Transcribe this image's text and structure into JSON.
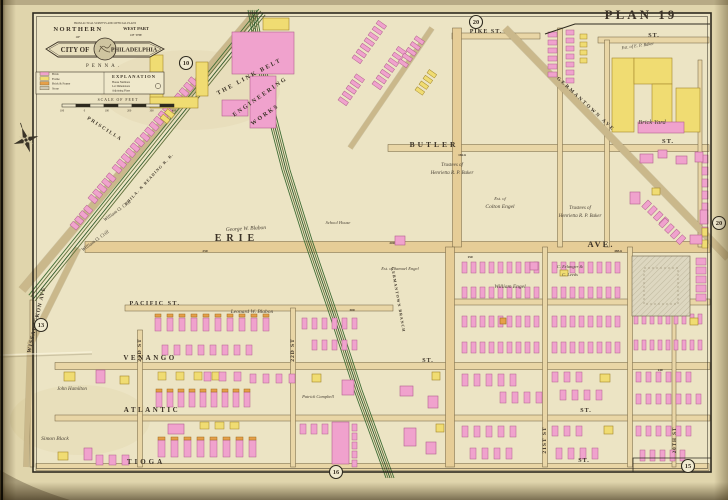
{
  "page": {
    "plate_label": "PLAN 19"
  },
  "cartouche": {
    "title_line1": "NORTHERN",
    "title_line1b": "OF",
    "title_line2": "WEST PART",
    "title_line2b": "OF THE",
    "arc_note": "FROM ACTUAL SURVEYS AND OFFICIAL PLANS",
    "banner_left": "CITY OF",
    "banner_right": "PHILADELPHIA",
    "subtitle": "PENNA."
  },
  "legend": {
    "title": "EXPLANATION",
    "items": [
      {
        "label": "Brick",
        "color": "#f0a2cd"
      },
      {
        "label": "Frame",
        "color": "#f0dc72"
      },
      {
        "label": "Brick & Frame",
        "color": "#e6a049"
      },
      {
        "label": "Stone",
        "color": "#cfc8b2"
      }
    ],
    "notes": [
      "House Numbers",
      "Lot Dimensions",
      "Adjoining Plans"
    ],
    "scale_title": "SCALE OF FEET",
    "scale_ticks": [
      "100",
      "0",
      "100",
      "200",
      "300",
      "400"
    ]
  },
  "plate_refs": [
    {
      "n": "10",
      "x": 186,
      "y": 63
    },
    {
      "n": "20",
      "x": 476,
      "y": 22
    },
    {
      "n": "20",
      "x": 719,
      "y": 223
    },
    {
      "n": "13",
      "x": 41,
      "y": 325
    },
    {
      "n": "16",
      "x": 336,
      "y": 472
    },
    {
      "n": "15",
      "x": 688,
      "y": 466
    }
  ],
  "map_labels": [
    {
      "t": "PIKE ST.",
      "x": 486,
      "y": 33,
      "s": 6,
      "ls": 1
    },
    {
      "t": "BUTLER",
      "x": 434,
      "y": 147,
      "s": 7.5,
      "ls": 3
    },
    {
      "t": "ST.",
      "x": 668,
      "y": 143,
      "s": 6.5,
      "ls": 1
    },
    {
      "t": "ST.",
      "x": 654,
      "y": 37,
      "s": 6,
      "ls": 1
    },
    {
      "t": "ERIE",
      "x": 237,
      "y": 241,
      "s": 10,
      "ls": 5
    },
    {
      "t": "AVE.",
      "x": 601,
      "y": 247,
      "s": 8.5,
      "ls": 2
    },
    {
      "t": "PACIFIC ST.",
      "x": 155,
      "y": 305,
      "s": 6,
      "ls": 1.5
    },
    {
      "t": "VENANGO",
      "x": 150,
      "y": 360,
      "s": 7,
      "ls": 2.5
    },
    {
      "t": "ST.",
      "x": 428,
      "y": 362,
      "s": 6,
      "ls": 1
    },
    {
      "t": "ATLANTIC",
      "x": 152,
      "y": 412,
      "s": 7,
      "ls": 2.5
    },
    {
      "t": "ST.",
      "x": 586,
      "y": 412,
      "s": 6,
      "ls": 1
    },
    {
      "t": "TIOGA",
      "x": 146,
      "y": 464,
      "s": 7,
      "ls": 3
    },
    {
      "t": "ST.",
      "x": 584,
      "y": 462,
      "s": 6,
      "ls": 1
    },
    {
      "t": "23D ST",
      "x": 141,
      "y": 350,
      "s": 5.5,
      "r": -90,
      "ls": 1
    },
    {
      "t": "22D ST",
      "x": 294,
      "y": 350,
      "s": 5.5,
      "r": -90,
      "ls": 1
    },
    {
      "t": "21ST ST",
      "x": 546,
      "y": 440,
      "s": 5.5,
      "r": -90,
      "ls": 1
    },
    {
      "t": "20TH ST",
      "x": 676,
      "y": 440,
      "s": 5,
      "r": -90,
      "ls": 1
    },
    {
      "t": "WISSAHICKON AVE",
      "x": 38,
      "y": 320,
      "s": 5.5,
      "r": -77,
      "ls": 1
    },
    {
      "t": "PRISCILLA",
      "x": 104,
      "y": 130,
      "s": 5,
      "r": 33,
      "ls": 1.5
    },
    {
      "t": "GERMANTOWN AVE",
      "x": 585,
      "y": 105,
      "s": 5,
      "r": 43,
      "ls": 2
    },
    {
      "t": "GERMANTOWN BRANCH",
      "x": 397,
      "y": 300,
      "s": 4,
      "r": 80,
      "ls": 1,
      "c": "#5a6b45"
    },
    {
      "t": "PHILA. & READING R. R.",
      "x": 150,
      "y": 180,
      "s": 4,
      "r": -47,
      "ls": 1,
      "c": "#5a6b45"
    },
    {
      "t": "THE LINK BELT",
      "x": 250,
      "y": 78,
      "s": 6,
      "r": -28,
      "ls": 2
    },
    {
      "t": "ENGINEERING",
      "x": 261,
      "y": 98,
      "s": 6,
      "r": -35,
      "ls": 2
    },
    {
      "t": "WORKS",
      "x": 266,
      "y": 116,
      "s": 6,
      "r": -35,
      "ls": 2
    },
    {
      "t": "Brick Yard",
      "x": 652,
      "y": 124,
      "s": 6.5,
      "f": "it"
    },
    {
      "t": "Est. of E. P. Baker",
      "x": 638,
      "y": 47,
      "s": 4.5,
      "f": "it",
      "r": -8
    },
    {
      "t": "Trustees of",
      "x": 452,
      "y": 166,
      "s": 5,
      "f": "it"
    },
    {
      "t": "Henrietta R. P. Baker",
      "x": 452,
      "y": 174,
      "s": 5,
      "f": "it"
    },
    {
      "t": "Trustees of",
      "x": 580,
      "y": 209,
      "s": 5,
      "f": "it"
    },
    {
      "t": "Henrietta R. P. Baker",
      "x": 580,
      "y": 217,
      "s": 5,
      "f": "it"
    },
    {
      "t": "Est. of",
      "x": 500,
      "y": 200,
      "s": 4.5,
      "f": "it"
    },
    {
      "t": "Colton Engel",
      "x": 500,
      "y": 208,
      "s": 5.5,
      "f": "it"
    },
    {
      "t": "William Engel",
      "x": 510,
      "y": 288,
      "s": 5.5,
      "f": "it"
    },
    {
      "t": "C. Erlanger &",
      "x": 570,
      "y": 268,
      "s": 4.5,
      "f": "it"
    },
    {
      "t": "C. Leeds",
      "x": 570,
      "y": 276,
      "s": 4.5,
      "f": "it"
    },
    {
      "t": "George W. Blabon",
      "x": 246,
      "y": 230,
      "s": 5.5,
      "f": "it",
      "r": -3
    },
    {
      "t": "Leonard W. Blabon",
      "x": 252,
      "y": 313,
      "s": 5.5,
      "f": "it"
    },
    {
      "t": "Est. of Samuel Engel",
      "x": 400,
      "y": 270,
      "s": 4.5,
      "f": "it"
    },
    {
      "t": "William O. Crill",
      "x": 118,
      "y": 212,
      "s": 5,
      "f": "it",
      "r": -36
    },
    {
      "t": "William O. Crill",
      "x": 96,
      "y": 242,
      "s": 5,
      "f": "it",
      "r": -36
    },
    {
      "t": "School House",
      "x": 338,
      "y": 224,
      "s": 4.5,
      "f": "it"
    },
    {
      "t": "John Hamilton",
      "x": 72,
      "y": 390,
      "s": 5,
      "f": "it"
    },
    {
      "t": "Simon Black",
      "x": 55,
      "y": 440,
      "s": 5.5,
      "f": "it"
    },
    {
      "t": "Patrick Campbell",
      "x": 318,
      "y": 398,
      "s": 4.5,
      "f": "it"
    },
    {
      "t": "150",
      "x": 470,
      "y": 258,
      "s": 3.5,
      "c": "#6b5f49"
    },
    {
      "t": "200",
      "x": 392,
      "y": 244,
      "s": 3.5,
      "c": "#6b5f49"
    },
    {
      "t": "485.6",
      "x": 618,
      "y": 252,
      "s": 3.5,
      "c": "#6b5f49"
    },
    {
      "t": "250",
      "x": 205,
      "y": 252,
      "s": 3.5,
      "c": "#6b5f49"
    },
    {
      "t": "182.6",
      "x": 462,
      "y": 156,
      "s": 3.5,
      "c": "#6b5f49"
    },
    {
      "t": "300",
      "x": 352,
      "y": 311,
      "s": 3.5,
      "c": "#6b5f49"
    },
    {
      "t": "140",
      "x": 660,
      "y": 371,
      "s": 3.5,
      "c": "#6b5f49"
    }
  ]
}
